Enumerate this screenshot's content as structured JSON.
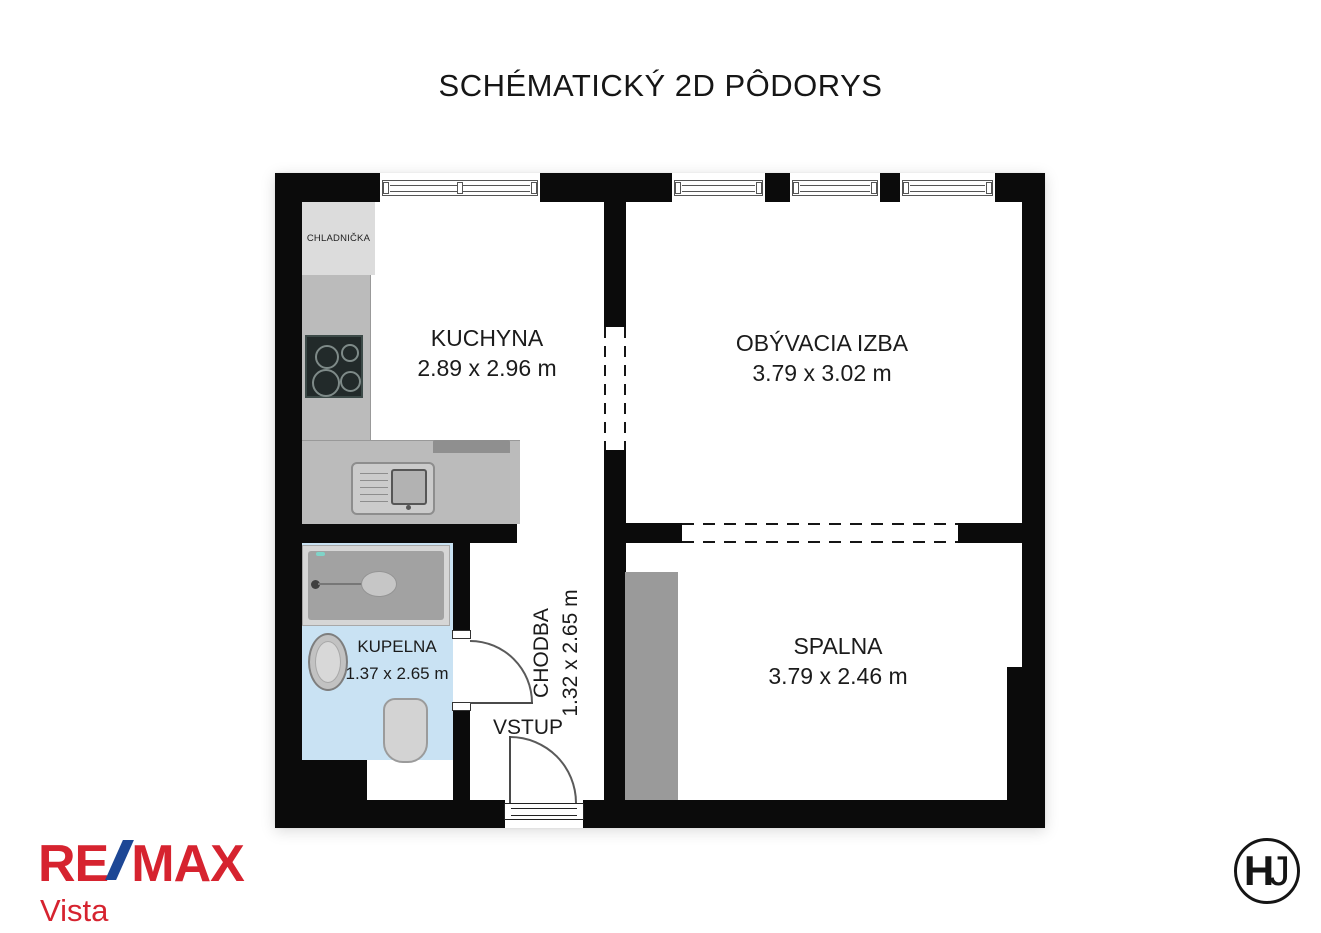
{
  "title": "SCHÉMATICKÝ 2D PÔDORYS",
  "plan": {
    "rooms": {
      "kuchyna": {
        "name": "KUCHYNA",
        "dims": "2.89 x 2.96 m"
      },
      "obyvacia": {
        "name": "OBÝVACIA IZBA",
        "dims": "3.79 x 3.02 m"
      },
      "chodba": {
        "name": "CHODBA",
        "dims": "1.32 x 2.65 m"
      },
      "kupelna": {
        "name": "KUPELNA",
        "dims": "1.37 x 2.65 m"
      },
      "spalna": {
        "name": "SPALNA",
        "dims": "3.79 x 2.46 m"
      }
    },
    "labels": {
      "entry": "VSTUP",
      "fridge": "CHLADNIČKA"
    }
  },
  "branding": {
    "remax": {
      "re": "RE",
      "max": "MAX",
      "sub": "Vista"
    },
    "monogram": {
      "h": "H",
      "j": "J"
    }
  },
  "colors": {
    "wall": "#0b0b0b",
    "bathroom_floor": "#c9e2f3",
    "counter_gray": "#bbbbbb",
    "wardrobe_gray": "#9a9a9a",
    "remax_red": "#d6232f",
    "remax_blue": "#1d4795"
  }
}
